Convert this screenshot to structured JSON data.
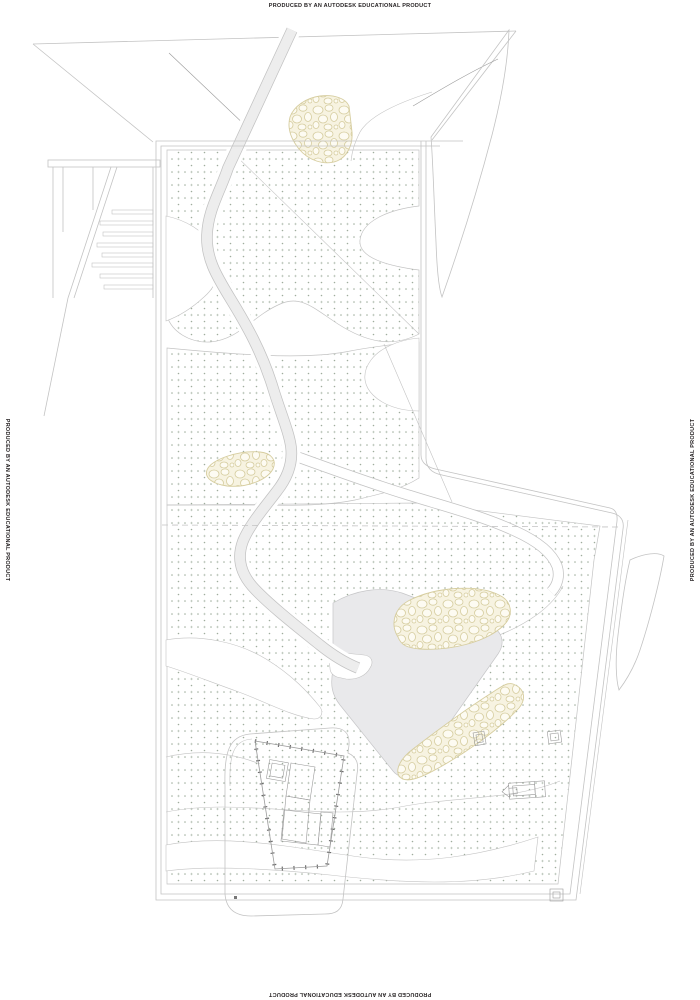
{
  "sheet": {
    "watermarks": {
      "top": "PRODUCED BY AN AUTODESK EDUCATIONAL PRODUCT",
      "bottom": "PRODUCED BY AN AUTODESK EDUCATIONAL PRODUCT",
      "left": "PRODUCED BY AN AUTODESK EDUCATIONAL PRODUCT",
      "right": "PRODUCED BY AN AUTODESK EDUCATIONAL PRODUCT"
    },
    "colors": {
      "paper": "#ffffff",
      "line_light": "#c3c3c3",
      "line_medium": "#9a9a9a",
      "line_dark": "#6e6e6e",
      "stipple_dot": "#9fad9d",
      "pebble_fill": "#f7f3e1",
      "pebble_stroke": "#d6cd9f",
      "path_fill": "#ededed",
      "plaza_fill": "#e9e9eb",
      "watermark_text": "#231f20"
    }
  }
}
